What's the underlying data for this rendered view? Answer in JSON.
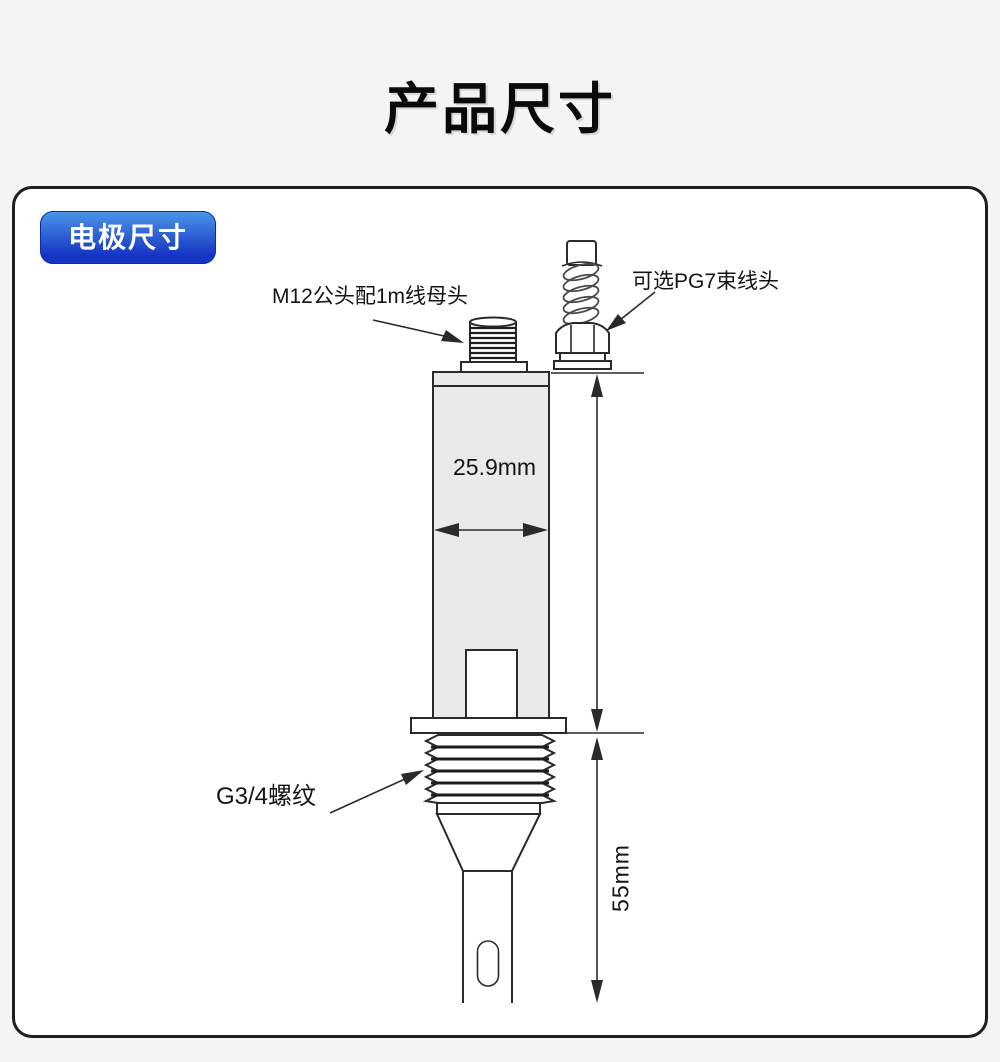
{
  "page": {
    "title": "产品尺寸",
    "background": "#f4f4f4"
  },
  "panel": {
    "badge_label": "电极尺寸",
    "labels": {
      "m12": "M12公头配1m线母头",
      "pg7": "可选PG7束线头",
      "body_width": "25.9mm",
      "thread": "G3/4螺纹",
      "probe_length": "55mm"
    },
    "colors": {
      "badge_gradient_top": "#4b95e8",
      "badge_gradient_bottom": "#1634c4",
      "line": "#2a2a2a",
      "body_fill": "#eaeaea"
    }
  }
}
